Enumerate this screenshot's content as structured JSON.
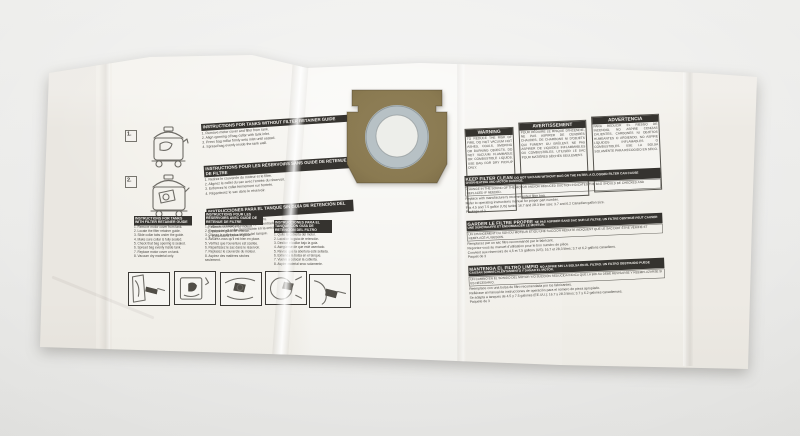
{
  "photo": {
    "subject": "Disposable wet/dry vacuum dust filter bag, laid flat on light backdrop"
  },
  "colors": {
    "backdrop": "#e8e8e6",
    "bag": "#f3f1ec",
    "collar_brown": "#8b7b52",
    "collar_ring_gray": "#b7c1c5",
    "header_bar_black": "#35332f"
  },
  "steps_top": {
    "step1": "1.",
    "step2": "2."
  },
  "instructions_without_guide": {
    "blocks": [
      {
        "lang": "en",
        "header": "Instructions for tanks without filter retainer guide",
        "body": [
          "1. Remove motor cover and filter from tank.",
          "2. Align opening of bag collar with tank inlet.",
          "3. Press bag collar firmly onto inlet until seated.",
          "4. Spread bag evenly inside the tank wall."
        ]
      },
      {
        "lang": "fr",
        "header": "Instructions pour les réservoirs sans guide de retenue de filtre",
        "body": [
          "1. Retirez le couvercle du moteur et le filtre.",
          "2. Alignez le collet du sac avec l'entrée du réservoir.",
          "3. Enfoncez le collet fermement sur l'entrée.",
          "4. Répartissez le sac dans le réservoir."
        ]
      },
      {
        "lang": "es",
        "header": "Instrucciones para el tanque sin guía de retención del filtro",
        "body": [
          "1. Quite la cubierta del motor y el filtro.",
          "2. Alinee el collar de la bolsa con la entrada.",
          "3. Presione el collar firmemente en la entrada.",
          "4. Extienda la bolsa dentro del tanque."
        ]
      }
    ]
  },
  "instructions_with_guide": {
    "blocks": [
      {
        "lang": "en",
        "header": "Instructions for tanks with filter retainer guide",
        "body": [
          "1. Remove motor cover from tank.",
          "2. Locate the filter retainer guide.",
          "3. Slide collar tabs under the guide.",
          "4. Make sure collar is fully seated.",
          "5. Check that bag opening is sealed.",
          "6. Spread bag evenly inside tank.",
          "7. Replace motor cover on tank.",
          "8. Vacuum dry material only."
        ]
      },
      {
        "lang": "fr",
        "header": "Instructions pour les réservoirs avec guide de retenue de filtre",
        "body": [
          "1. Retirez le couvercle du moteur.",
          "2. Repérez le guide de retenue.",
          "3. Glissez le collet sous le guide.",
          "4. Assurez-vous qu'il est bien en place.",
          "5. Vérifiez que l'ouverture est scellée.",
          "6. Répartissez le sac dans le réservoir.",
          "7. Replacez le couvercle du moteur.",
          "8. Aspirez des matières sèches seulement."
        ]
      },
      {
        "lang": "es",
        "header": "Instrucciones para el tanque con guía de retención del filtro",
        "body": [
          "1. Quite la cubierta del motor.",
          "2. Localice la guía de retención.",
          "3. Deslice el collar bajo la guía.",
          "4. Asegúrese de que esté asentado.",
          "5. Revise que la abertura esté sellada.",
          "6. Extienda la bolsa en el tanque.",
          "7. Vuelva a colocar la cubierta.",
          "8. Aspire material seco solamente."
        ]
      }
    ]
  },
  "warning_boxes": [
    {
      "title": "WARNING",
      "body": [
        "TO REDUCE THE RISK OF FIRE, DO NOT VACUUM HOT ASHES, COALS, SMOKING OR BURNING OBJECTS. DO NOT VACUUM FLAMMABLE OR COMBUSTIBLE LIQUIDS. USE BAG FOR DRY PICKUP ONLY."
      ]
    },
    {
      "title": "AVERTISSEMENT",
      "body": [
        "POUR RÉDUIRE LE RISQUE D'INCENDIE, NE PAS ASPIRER DE CENDRES CHAUDES, DE CHARBONS NI D'OBJETS QUI FUMENT OU BRÛLENT. NE PAS ASPIRER DE LIQUIDES INFLAMMABLES OU COMBUSTIBLES. UTILISER LE SAC POUR MATIÈRES SÈCHES SEULEMENT."
      ]
    },
    {
      "title": "ADVERTENCIA",
      "body": [
        "PARA REDUCIR EL RIESGO DE INCENDIO, NO ASPIRE CENIZAS CALIENTES, CARBONES NI OBJETOS HUMEANTES O ARDIENDO. NO ASPIRE LÍQUIDOS INFLAMABLES O COMBUSTIBLES. USE LA BOLSA SOLAMENTE PARA RECOGIDO EN SECO."
      ]
    }
  ],
  "filter_care": [
    {
      "bar_title": "KEEP FILTER CLEAN",
      "bar_text": "DO NOT VACUUM WITHOUT BAG ON THE FILTER. A CLOGGED FILTER CAN CAUSE OVERHEATING AND MOTOR DAMAGE.",
      "boxed": "CHANGE IN THE SOUND OF THE MOTOR AND/OR REDUCED SUCTION INDICATES THE BAG SHOULD BE CHECKED AND REPLACED IF NEEDED.",
      "lines": [
        "Replace with manufacturer's recommended filter bag.",
        "Refer to operating instructions manual for proper part number.",
        "Fits 4.5 and 7.5 gallon (US) tanks; 16.7 and 28.3 liter size; 3.7 and 6.2 Canadian gallon size.",
        "Package of 3"
      ]
    },
    {
      "bar_title": "GARDER LE FILTRE PROPRE",
      "bar_text": "NE PAS ASPIRER SANS SAC SUR LE FILTRE. UN FILTRE OBSTRUÉ PEUT CAUSER UNE SURCHAUFFE ET ENDOMMAGER LE MOTEUR.",
      "boxed": "UN CHANGEMENT DU SON DU MOTEUR ET/OU UNE SUCCION RÉDUITE INDIQUENT QUE LE SAC DOIT ÊTRE VÉRIFIÉ ET REMPLACÉ AU BESOIN.",
      "lines": [
        "Remplacez par un sac filtre recommandé par le fabricant.",
        "Reportez-vous au manuel d'utilisation pour le bon numéro de pièce.",
        "Convient aux réservoirs de 4,5 et 7,5 gallons (US); 16,7 et 28,3 litres; 3,7 et 6,2 gallons canadiens.",
        "Paquet de 3"
      ]
    },
    {
      "bar_title": "MANTENGA EL FILTRO LIMPIO",
      "bar_text": "NO ASPIRE SIN LA BOLSA EN EL FILTRO. UN FILTRO OBSTRUIDO PUEDE CAUSAR SOBRECALENTAMIENTO Y DAÑAR EL MOTOR.",
      "boxed": "UN CAMBIO EN EL SONIDO DEL MOTOR Y/O SUCCIÓN REDUCIDA INDICA QUE LA BOLSA DEBE REVISARSE Y REEMPLAZARSE SI ES NECESARIO.",
      "lines": [
        "Reemplace con una bolsa de filtro recomendada por los fabricantes.",
        "Refiérase al manual de instrucciones de operación para el número de pieza apropiado.",
        "Se adapta a tanques de 4.5 y 7.5 galones (EE.UU.); 16.7 y 28.3 litros; 3.7 y 6.2 galones canadienses.",
        "Paquete de 3"
      ]
    }
  ],
  "step_illustration_icons": [
    "insert-collar-into-guide",
    "position-bag-in-tank",
    "press-collar-on-inlet",
    "check-collar-seated",
    "reattach-hose"
  ]
}
